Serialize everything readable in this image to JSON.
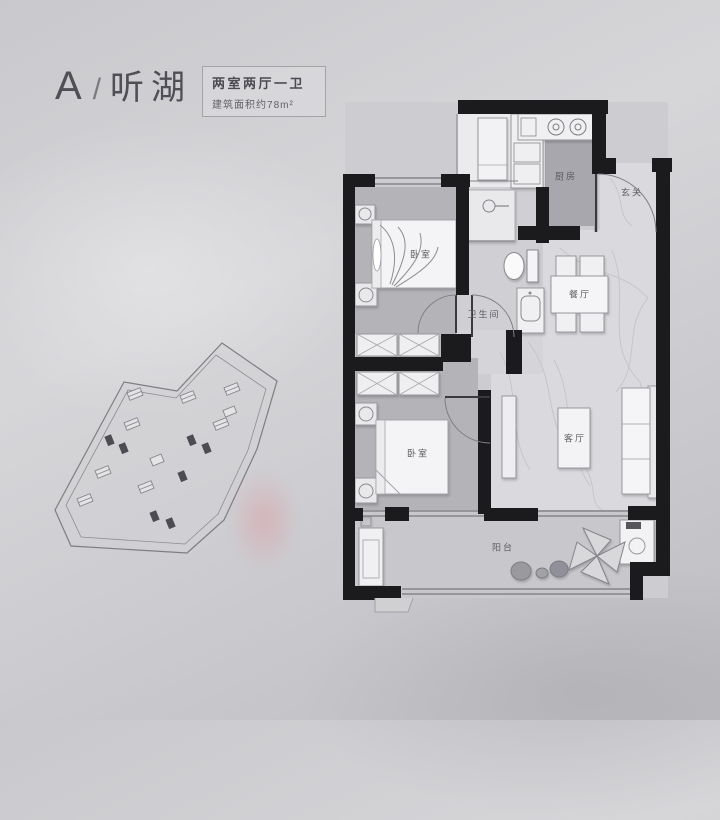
{
  "header": {
    "plan_letter": "A",
    "separator": "/",
    "plan_name": "听湖",
    "spec_line1": "两室两厅一卫",
    "spec_line2": "建筑面积约78m²"
  },
  "rooms": {
    "kitchen": "厨房",
    "entry": "玄关",
    "bedroom1": "卧室",
    "bathroom": "卫生间",
    "dining": "餐厅",
    "bedroom2": "卧室",
    "living": "客厅",
    "balcony": "阳台"
  },
  "colors": {
    "wall": "#1b1b1e",
    "bedroom_floor": "#b3b3b8",
    "hall_floor": "#d9d9dc",
    "kitchen_floor": "#a7a7ad",
    "balcony_floor": "#c8c8cc",
    "background_top": "#c9c9cd",
    "background_bottom": "#bdbdc1",
    "watermark_pink": "#e18a92"
  }
}
